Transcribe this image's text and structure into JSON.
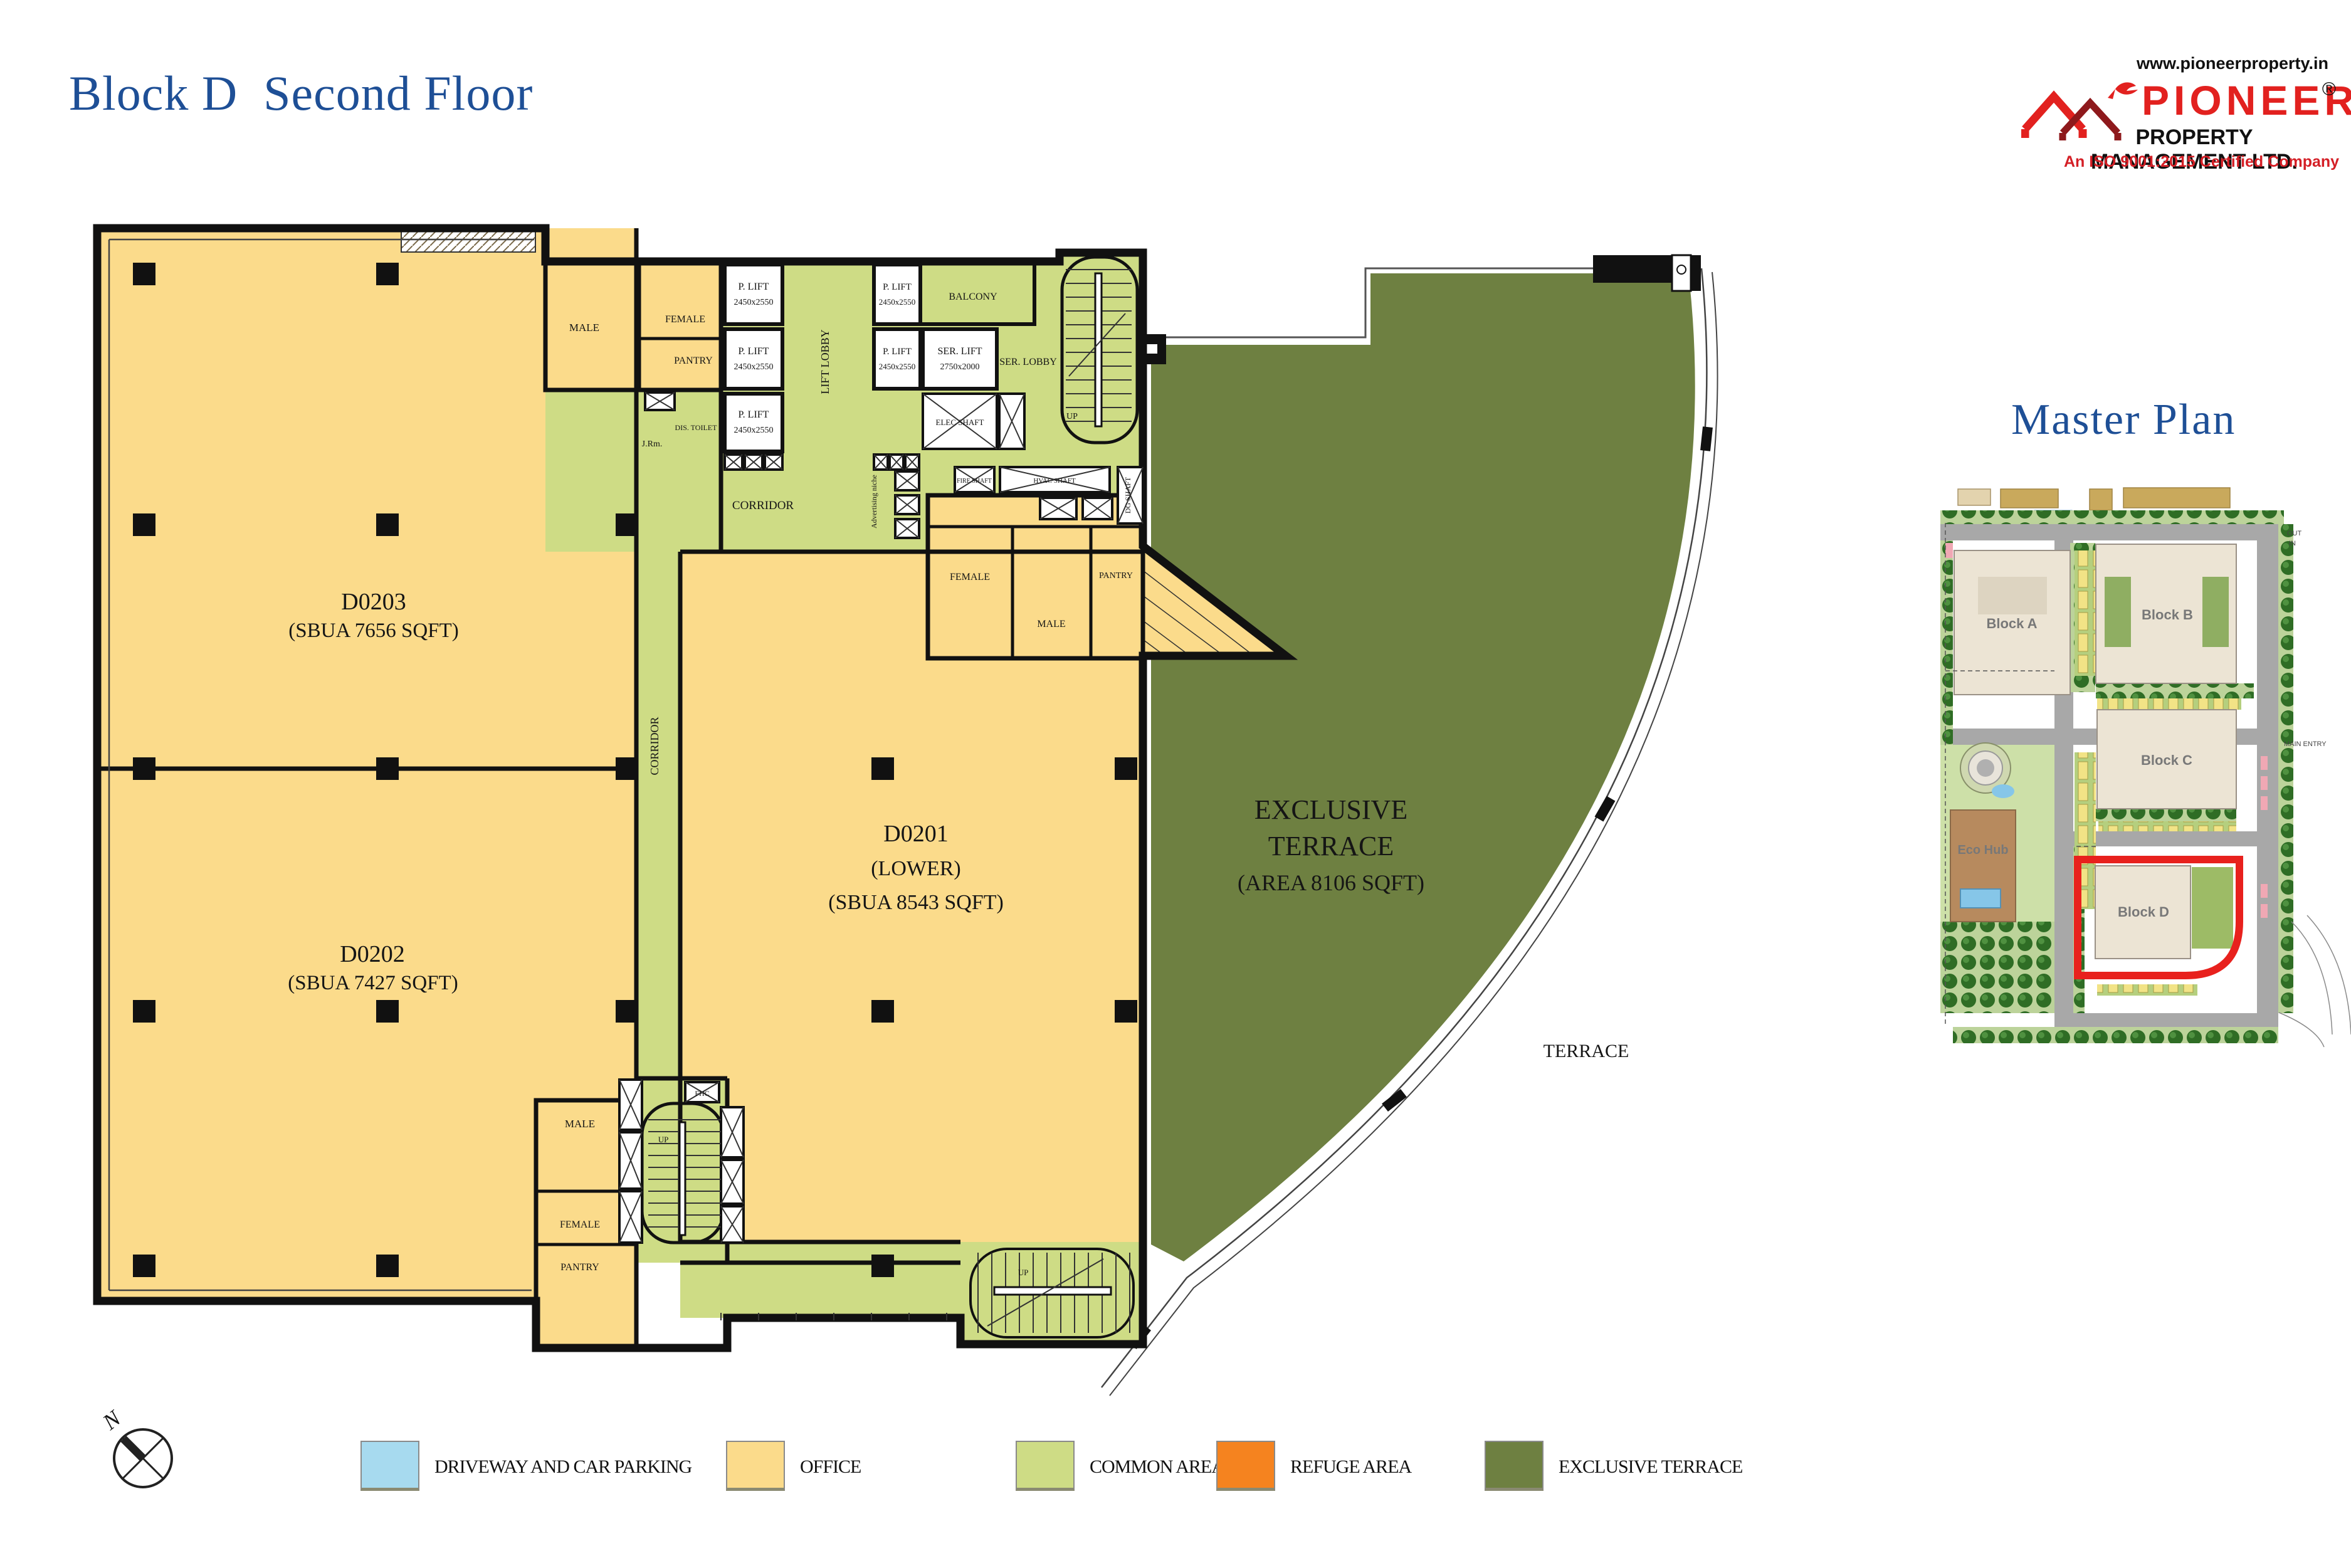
{
  "header": {
    "title": "Block D  Second Floor"
  },
  "logo": {
    "website": "www.pioneerproperty.in",
    "brand": "PIONEER",
    "reg": "®",
    "company": "PROPERTY MANAGEMENT LTD.",
    "tagline": "An ISO 9001:2015 Certified Company"
  },
  "master_plan": {
    "title": "Master Plan",
    "blocks": {
      "a": "Block A",
      "b": "Block B",
      "c": "Block C",
      "eco": "Eco Hub",
      "d": "Block D"
    },
    "entry": {
      "out": "OUT",
      "in": "IN",
      "main": "MAIN ENTRY"
    }
  },
  "plan": {
    "units": {
      "d0203": {
        "id": "D0203",
        "area": "(SBUA 7656 SQFT)"
      },
      "d0202": {
        "id": "D0202",
        "area": "(SBUA 7427 SQFT)"
      },
      "d0201": {
        "id": "D0201",
        "lower": "(LOWER)",
        "area": "(SBUA 8543 SQFT)"
      }
    },
    "terrace": {
      "line1": "EXCLUSIVE",
      "line2": "TERRACE",
      "line3": "(AREA 8106 SQFT)",
      "outside": "TERRACE"
    },
    "labels": {
      "male": "MALE",
      "female": "FEMALE",
      "pantry": "PANTRY",
      "corridor": "CORRIDOR",
      "lift_lobby": "LIFT LOBBY",
      "p_lift": "P. LIFT",
      "p_lift_size": "2450x2550",
      "ser_lift": "SER. LIFT",
      "ser_lift_size": "2750x2000",
      "ser_lobby": "SER. LOBBY",
      "balcony": "BALCONY",
      "elec_shaft": "ELEC SHAFT",
      "hvac_shaft": "HVAC SHAFT",
      "fire_shaft": "FIRE SHAFT",
      "dg_shaft": "DG SHAFT",
      "dis_toilet": "DIS. TOILET",
      "jrm": "J.Rm.",
      "fhc": "FHC",
      "up": "UP",
      "adv": "Advertising niche"
    },
    "compass_n": "N"
  },
  "legend": {
    "items": [
      {
        "label": "DRIVEWAY AND CAR PARKING",
        "color": "#a7daef"
      },
      {
        "label": "OFFICE",
        "color": "#fbdb8b"
      },
      {
        "label": "COMMON AREA",
        "color": "#cedc85"
      },
      {
        "label": "REFUGE AREA",
        "color": "#f5831f"
      },
      {
        "label": "EXCLUSIVE TERRACE",
        "color": "#6e8041"
      }
    ]
  },
  "colors": {
    "office": "#fbdb8b",
    "common": "#cedc85",
    "exclusive_terrace": "#6e8041",
    "driveway": "#a7daef",
    "refuge": "#f5831f",
    "title_blue": "#1e4f96",
    "brand_red": "#e2211f",
    "wall_black": "#111111"
  }
}
